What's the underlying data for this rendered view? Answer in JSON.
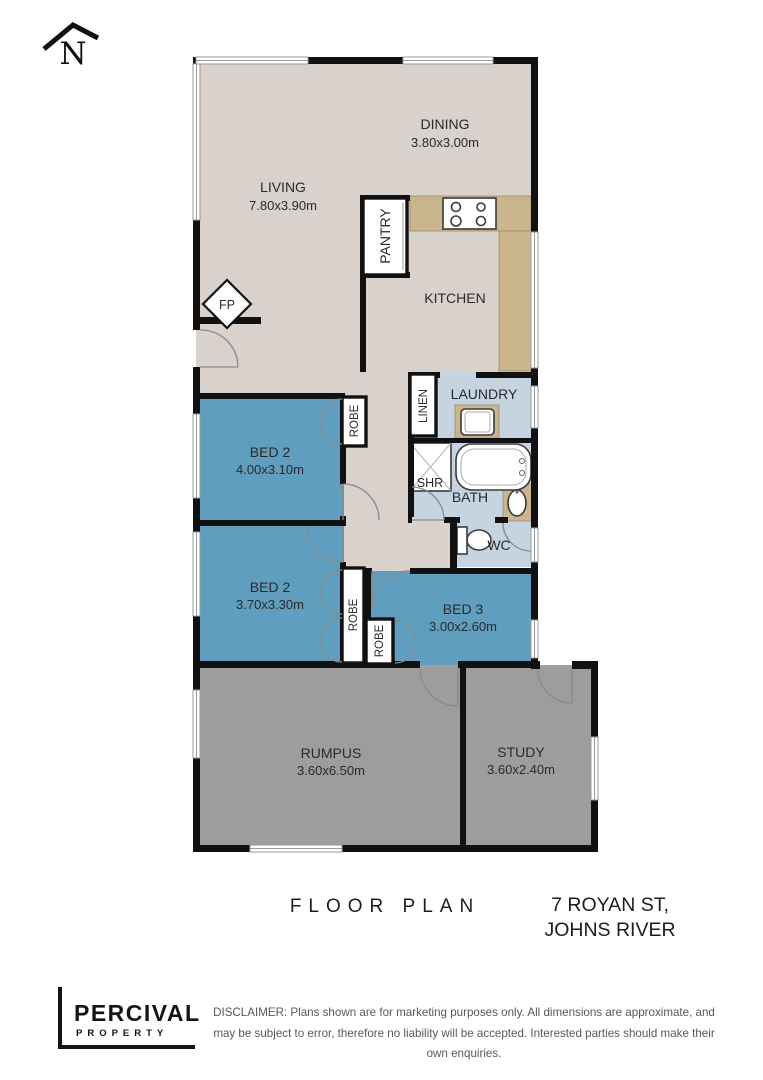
{
  "north": {
    "label": "N"
  },
  "colors": {
    "floor_main": "#d8d1cc",
    "floor_bed": "#5f9ebf",
    "floor_wet": "#c6d4e2",
    "floor_common": "#9d9d9b",
    "bench": "#cbb58d",
    "wall": "#111111"
  },
  "rooms": {
    "living": {
      "label": "LIVING",
      "dims": "7.80x3.90m"
    },
    "dining": {
      "label": "DINING",
      "dims": "3.80x3.00m"
    },
    "kitchen": {
      "label": "KITCHEN"
    },
    "pantry": {
      "label": "PANTRY"
    },
    "laundry": {
      "label": "LAUNDRY"
    },
    "linen": {
      "label": "LINEN"
    },
    "shower": {
      "label": "SHR"
    },
    "bath": {
      "label": "BATH"
    },
    "wc": {
      "label": "WC"
    },
    "bed2a": {
      "label": "BED 2",
      "dims": "4.00x3.10m"
    },
    "bed2b": {
      "label": "BED 2",
      "dims": "3.70x3.30m"
    },
    "bed3": {
      "label": "BED 3",
      "dims": "3.00x2.60m"
    },
    "robe": {
      "label": "ROBE"
    },
    "rumpus": {
      "label": "RUMPUS",
      "dims": "3.60x6.50m"
    },
    "study": {
      "label": "STUDY",
      "dims": "3.60x2.40m"
    },
    "fireplace": {
      "label": "FP"
    }
  },
  "footer": {
    "title": "FLOOR PLAN",
    "address_line1": "7 ROYAN ST,",
    "address_line2": "JOHNS RIVER",
    "brand_name": "PERCIVAL",
    "brand_sub": "PROPERTY",
    "disclaimer": "DISCLAIMER: Plans shown are for marketing purposes only. All dimensions are approximate, and may be subject to error, therefore no liability will be accepted. Interested parties should make their own enquiries."
  }
}
